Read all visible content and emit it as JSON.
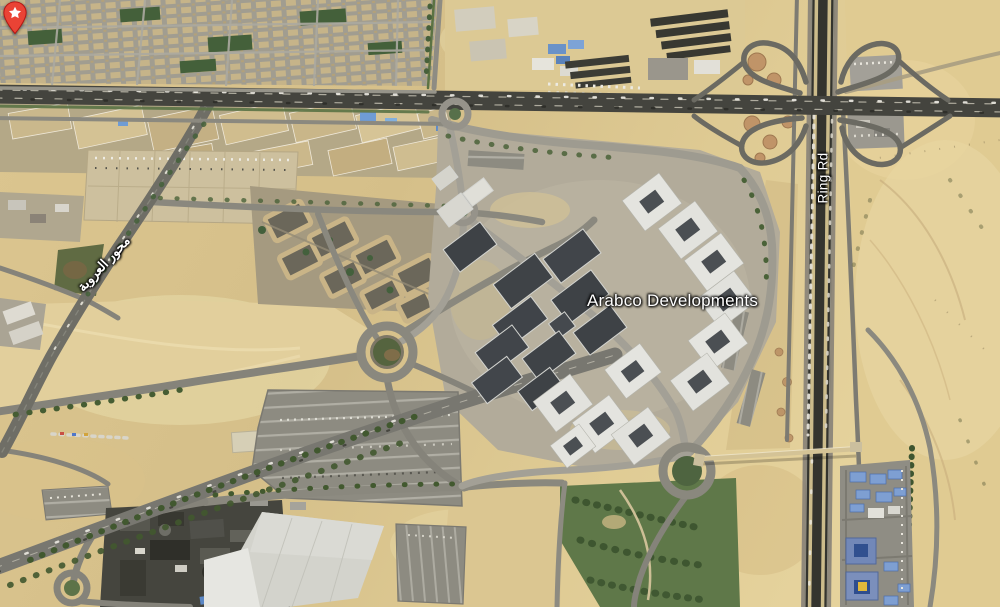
{
  "map_view": {
    "type": "3d-satellite-aerial",
    "place": {
      "name": "Arabco Developments"
    },
    "marker": {
      "shape": "teardrop-pin",
      "color": "#EA4335",
      "border_color": "#B31412",
      "icon": "star-icon",
      "icon_color": "#FFFFFF"
    },
    "road_labels": [
      {
        "text": "Ring Rd",
        "orientation": "vertical-along-road",
        "script": "latin"
      },
      {
        "text": "محور العروبة",
        "orientation": "diagonal-along-road",
        "script": "arabic"
      }
    ],
    "terrain_palette": {
      "desert_sand": "#d9c28b",
      "light_sand": "#e6d6a6",
      "highway_asphalt": "#44443e",
      "local_road": "#85837a",
      "ring_road_median": "#ccbc8b",
      "building_white": "#e4e4df",
      "building_dark_roof": "#3f4347",
      "residential_block": "#c6b489",
      "vegetation_dark": "#3f5531",
      "vegetation_light": "#5f7849",
      "parking_lot": "#8d8b81",
      "blue_roof": "#7e9fd2"
    }
  }
}
